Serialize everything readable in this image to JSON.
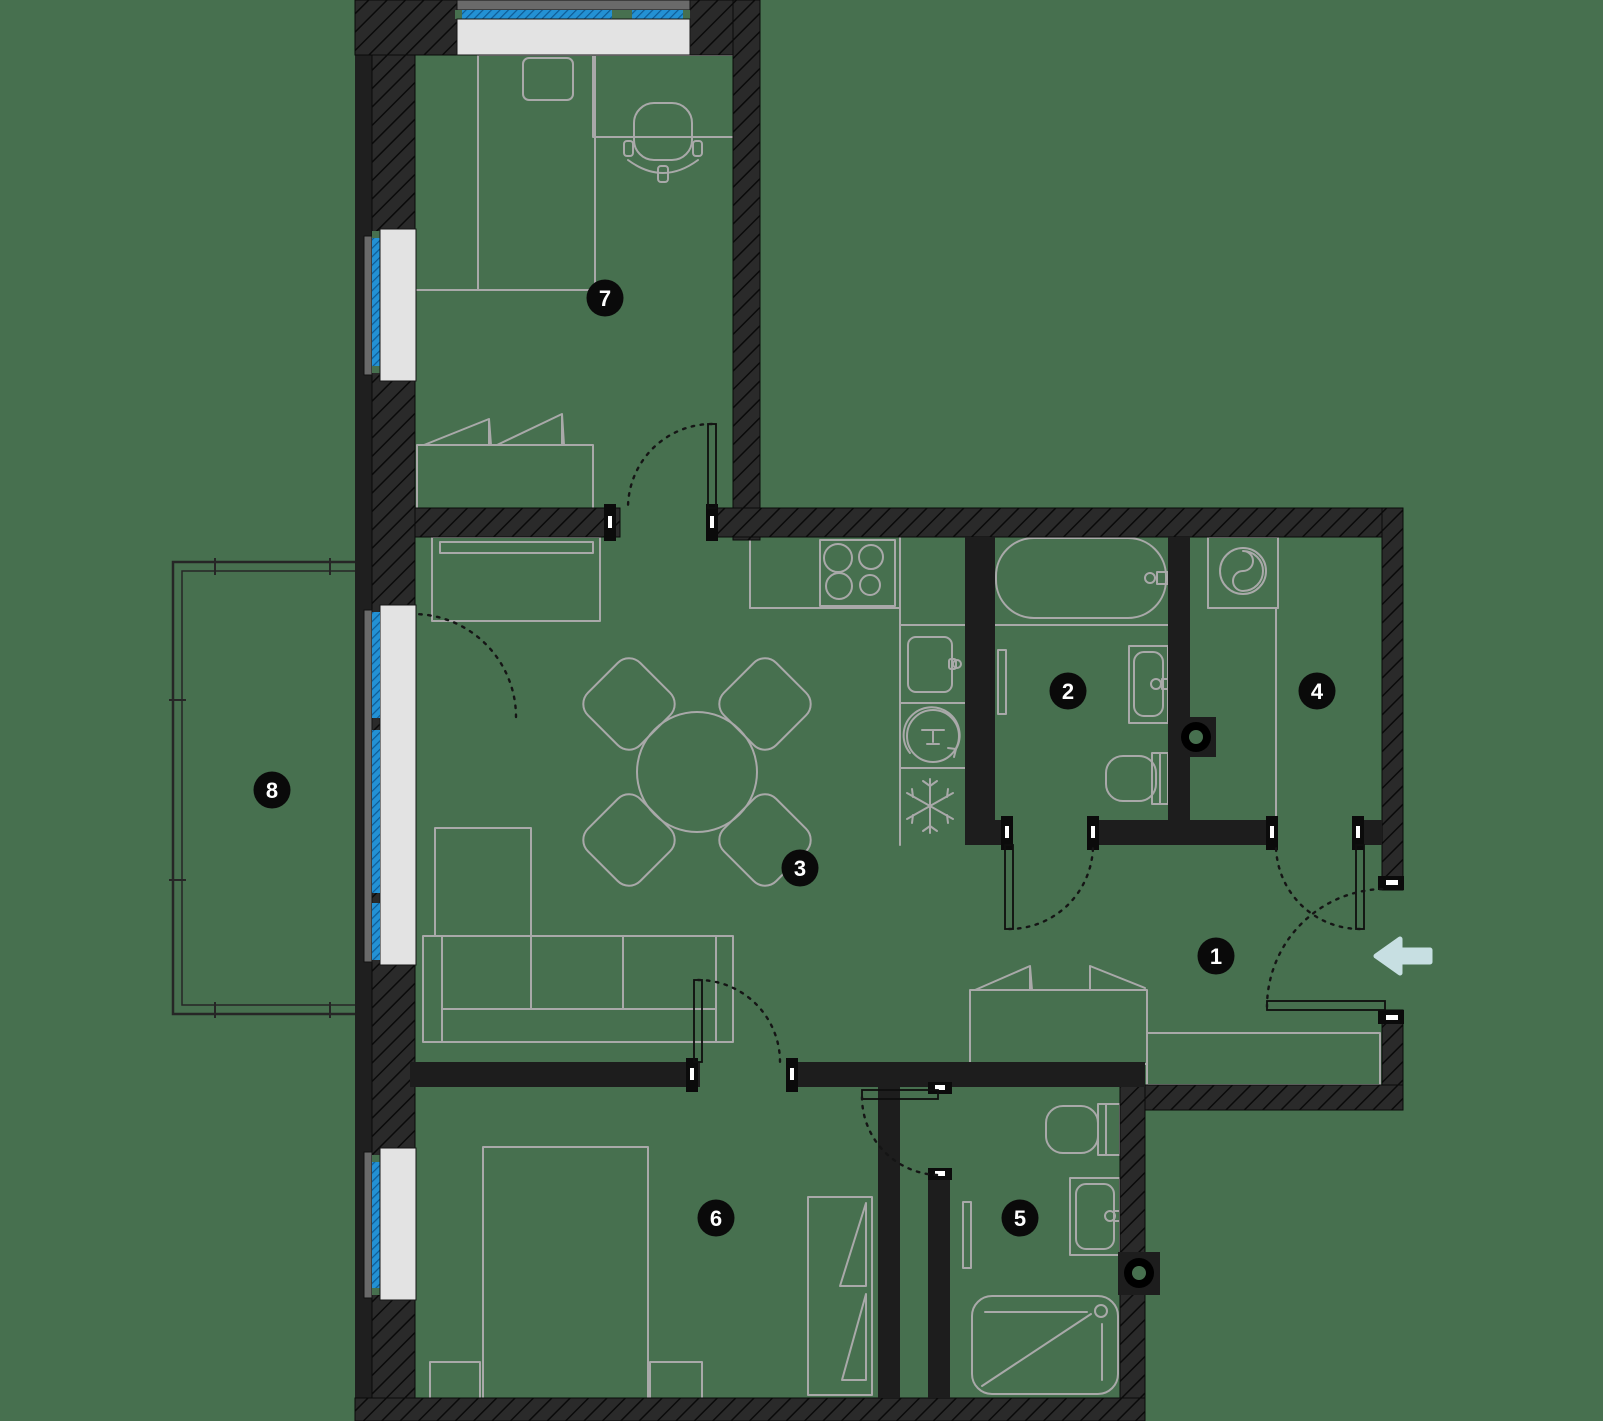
{
  "page": {
    "title": "Apartment floor plan"
  },
  "rooms": [
    {
      "label": "1"
    },
    {
      "label": "2"
    },
    {
      "label": "3"
    },
    {
      "label": "4"
    },
    {
      "label": "5"
    },
    {
      "label": "6"
    },
    {
      "label": "7"
    },
    {
      "label": "8"
    }
  ],
  "entrance": {
    "icon": "entrance-arrow-icon",
    "direction": "left",
    "color": "#C7DFE2"
  },
  "palette": {
    "background": "#47704F",
    "exterior_wall": "#2A2A2A",
    "wall_hatch": "#0A0A0A",
    "partition_wall": "#1D1D1D",
    "furniture_line": "#A9A9A9",
    "window_glass": "#2391D4",
    "window_glass_hatch": "#0E5A94",
    "window_sill": "#E3E3E3",
    "concrete_slab": "#6A6A6A",
    "badge": "#0A0A0A",
    "badge_text": "#FFFFFF"
  },
  "icons": {
    "entrance": "entrance-arrow-icon",
    "fridge": "snowflake-icon",
    "dishwasher": "dishwasher-icon",
    "washing_machine": "washing-machine-icon",
    "stove": "stove-burners-icon",
    "bathtub": "bathtub-icon",
    "shower": "shower-icon",
    "toilet": "toilet-icon",
    "sink": "sink-icon",
    "shaft": "pipe-shaft-icon"
  }
}
